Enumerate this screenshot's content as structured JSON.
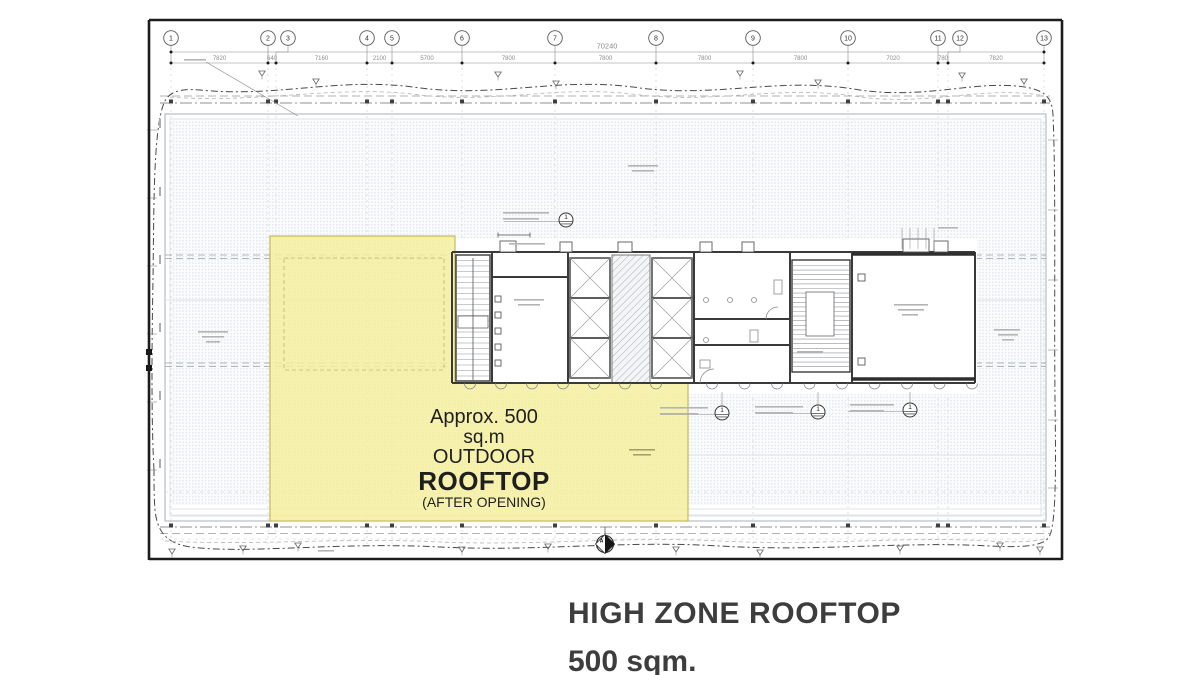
{
  "drawing": {
    "grid": {
      "bubbles": [
        "1",
        "2",
        "3",
        "4",
        "5",
        "6",
        "7",
        "8",
        "9",
        "10",
        "11",
        "12",
        "13"
      ],
      "total_dim": "70240",
      "segment_dims": [
        "7820",
        "640",
        "7160",
        "2100",
        "5700",
        "7800",
        "7800",
        "7800",
        "7800",
        "7020",
        "780",
        "7820"
      ]
    },
    "callouts": {
      "label": "1"
    },
    "compass": {
      "label": "A"
    },
    "highlight": {
      "line1": "Approx. 500",
      "line2": "sq.m",
      "line3": "OUTDOOR",
      "line4": "ROOFTOP",
      "line5": "(AFTER OPENING)",
      "fill": "#f4ef9f",
      "border": "#bcae45"
    }
  },
  "caption": {
    "title": "HIGH ZONE ROOFTOP",
    "subtitle": "500 sqm.",
    "color": "#3d3d3d"
  }
}
